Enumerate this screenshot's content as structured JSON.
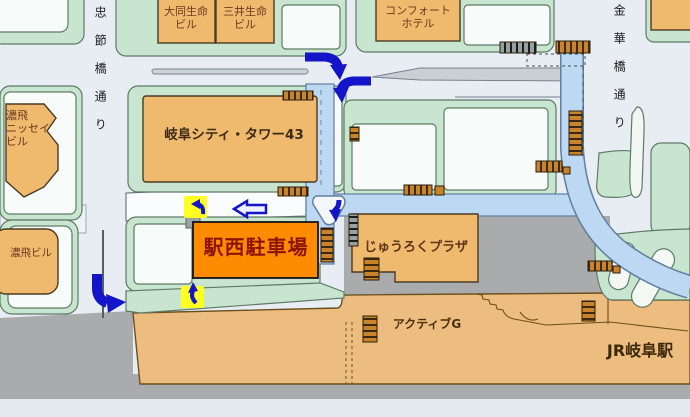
{
  "colors": {
    "road_background": "#e7edf2",
    "block_green": "#c8e5cf",
    "building_tan": "#f0ba6e",
    "parking_orange": "#ff8c00",
    "parking_text_red": "#8c1400",
    "station_tan": "#ecbd7e",
    "gray_area": "#a9abac",
    "access_road_blue": "#bcd8f2",
    "arrow_blue": "#1414c8",
    "highlight_yellow": "#ffff20"
  },
  "streets": {
    "chusetsubashi_dori": "忠節橋通り",
    "kinkabashi_dori": "金華橋通り"
  },
  "places": {
    "daido_seimei_biru": "大同生命\nビル",
    "mitsui_seimei_biru": "三井生命\nビル",
    "comfort_hotel": "コンフォート\nホテル",
    "nohhi_nissei_biru": "濃飛\nニッセイ\nビル",
    "gifu_city_tower_43": "岐阜シティ・タワー43",
    "nohhi_biru": "濃飛ビル",
    "ekinishi_parking": "駅西駐車場",
    "juroku_plaza": "じゅうろくプラザ",
    "active_g": "アクティブG",
    "jr_gifu_station": "JR岐阜駅"
  }
}
